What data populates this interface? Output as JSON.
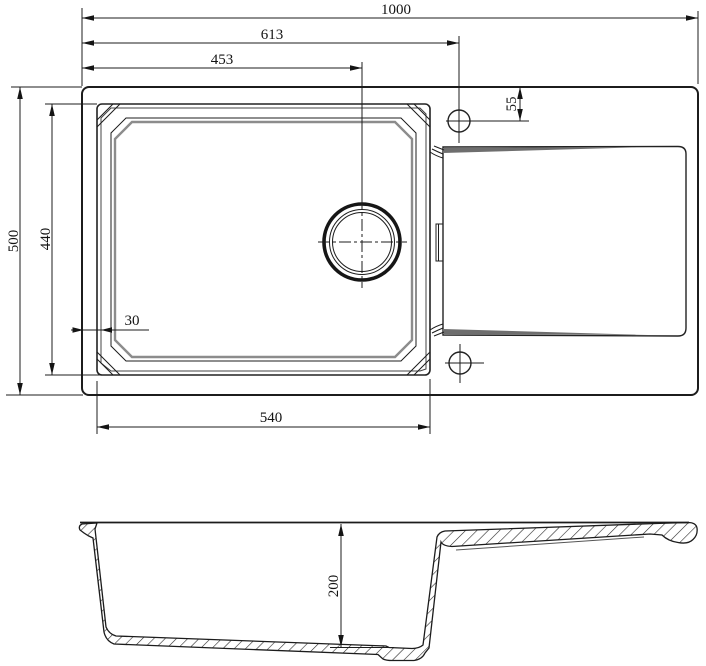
{
  "drawing": {
    "background": "#ffffff",
    "line_color": "#1c1c1c",
    "shade_color": "#8c8c8c",
    "top_view": {
      "dim_overall_width": "1000",
      "dim_faucet_hole_offset": "613",
      "dim_drain_offset": "453",
      "dim_faucet_hole_from_edge": "55",
      "dim_overall_depth": "500",
      "dim_bowl_outer_depth": "440",
      "dim_rim_margin": "30",
      "dim_bowl_outer_width": "540"
    },
    "section_view": {
      "dim_bowl_depth": "200"
    }
  }
}
